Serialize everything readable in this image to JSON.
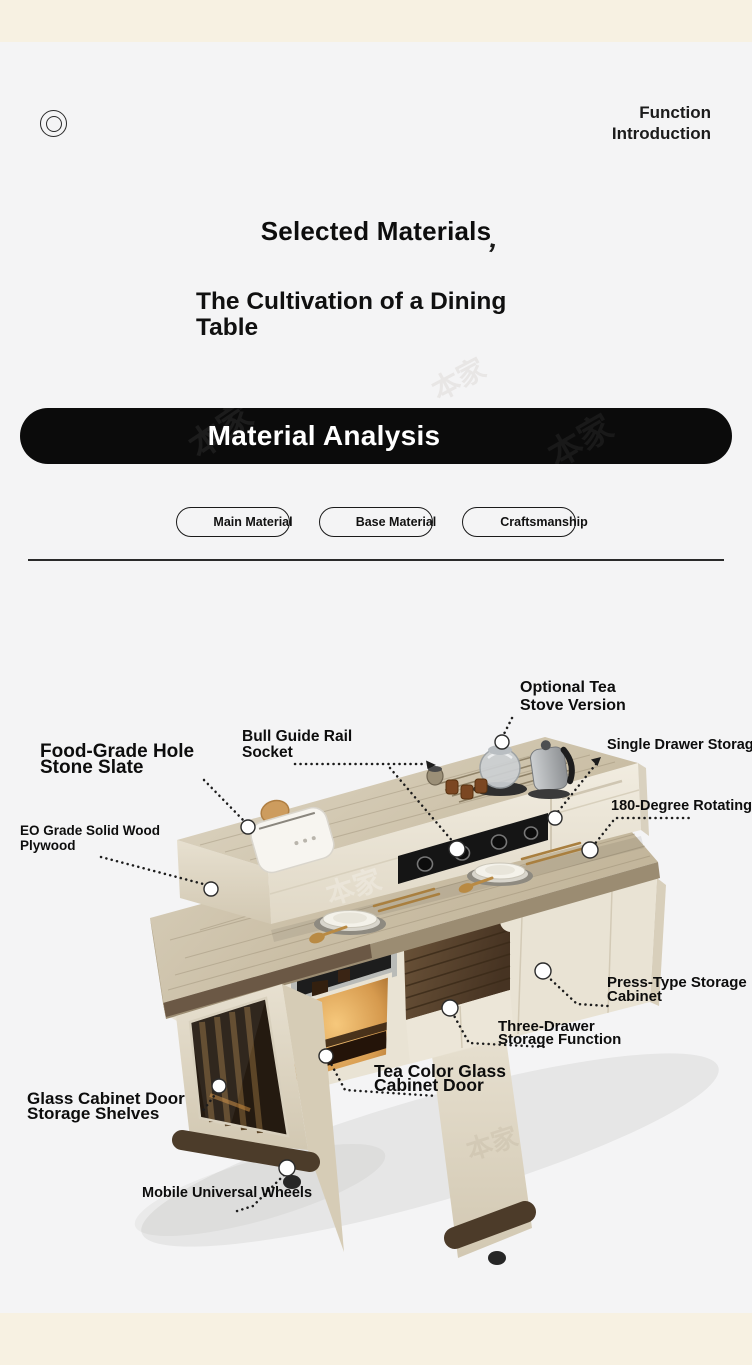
{
  "page": {
    "background": "#f4f4f5",
    "band_color": "#f7f1e2",
    "accent_black": "#0b0b0b",
    "top_band": "",
    "bottom_band": ""
  },
  "watermark": {
    "text": "本家"
  },
  "header": {
    "line1": "Function",
    "line2": "Introduction"
  },
  "hero": {
    "title": "Selected Materials",
    "flourish": "’",
    "subtitle": "The Cultivation of a Dining Table"
  },
  "banner": {
    "label": "Material Analysis"
  },
  "tabs": [
    {
      "label": "Main Material"
    },
    {
      "label": "Base Material"
    },
    {
      "label": "Craftsmanship"
    }
  ],
  "callouts": {
    "optional_tea": {
      "l1": "Optional Tea",
      "l2": "Stove Version"
    },
    "single_drawer": {
      "l1": "Single Drawer Storage Area"
    },
    "rotating": {
      "l1": "180-Degree Rotating Table"
    },
    "bull_guide": {
      "l1": "Bull Guide Rail",
      "l2": "Socket"
    },
    "food_grade": {
      "l1": "Food-Grade Hole",
      "l2": "Stone Slate"
    },
    "eo_grade": {
      "l1": "EO Grade Solid Wood",
      "l2": "Plywood"
    },
    "press_type": {
      "l1": "Press-Type Storage",
      "l2": "Cabinet"
    },
    "three_drawer": {
      "l1": "Three-Drawer",
      "l2": "Storage Function"
    },
    "tea_glass": {
      "l1": "Tea Color Glass",
      "l2": "Cabinet Door"
    },
    "glass_shelves": {
      "l1": "Glass Cabinet Door",
      "l2": "Storage Shelves"
    },
    "wheels": {
      "l1": "Mobile Universal Wheels"
    }
  }
}
